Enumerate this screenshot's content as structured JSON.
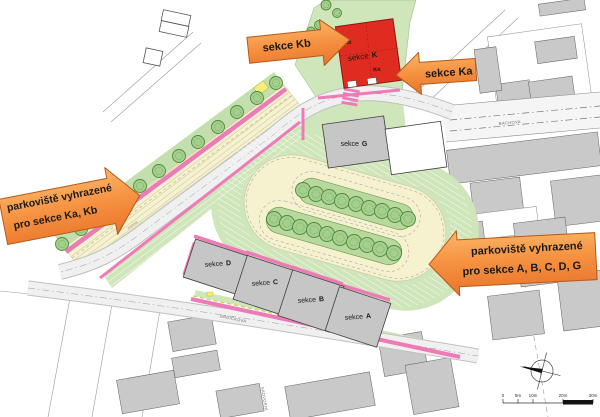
{
  "callouts": {
    "kb": "sekce Kb",
    "ka": "sekce Ka",
    "parking_left_line1": "parkoviště vyhrazené",
    "parking_left_line2": "pro sekce Ka, Kb",
    "parking_right_line1": "parkoviště vyhrazené",
    "parking_right_line2": "pro sekce A, B, C, D, G"
  },
  "buildings": {
    "k": {
      "prefix": "sekce",
      "letter": "K",
      "annex_top": "Kb",
      "annex_bottom": "Ka"
    },
    "g": {
      "prefix": "sekce",
      "letter": "G"
    },
    "d": {
      "prefix": "sekce",
      "letter": "D"
    },
    "c": {
      "prefix": "sekce",
      "letter": "C"
    },
    "b": {
      "prefix": "sekce",
      "letter": "B"
    },
    "a": {
      "prefix": "sekce",
      "letter": "A"
    }
  },
  "streets": {
    "right": "BACHOVA",
    "bottom": "BRDIČKOVA",
    "left": "NÁDVORNÍ"
  },
  "notes": {
    "reserve": "rezerva"
  },
  "scale_bar": {
    "labels": [
      "0",
      "5m",
      "10m",
      "20m",
      "30m"
    ]
  },
  "colors": {
    "callout_orange": "#ed7d31",
    "building_red": "#e02b20",
    "context_gray": "#c9c9c9",
    "green": "#cfe5ba",
    "pink": "#ee7ab7",
    "cream": "#f6f1cf"
  }
}
